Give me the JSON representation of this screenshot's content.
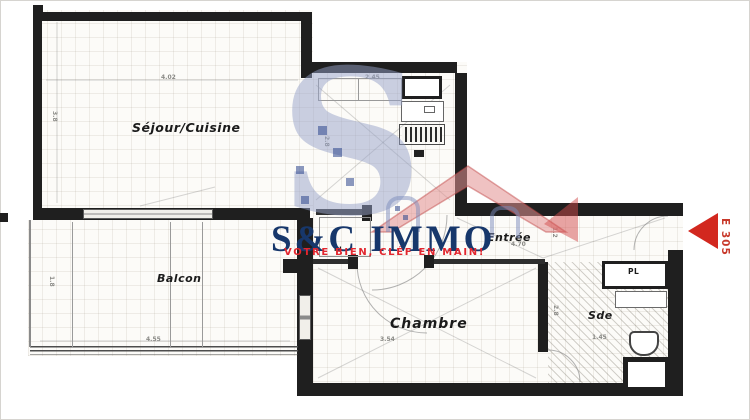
{
  "logo": {
    "title": "S&C IMMO",
    "tagline": "VOTRE BIEN, CLÉF EN MAIN!",
    "watermark_letter": "S"
  },
  "entry_marker": {
    "label": "E 305"
  },
  "rooms": {
    "sejour": {
      "label": "Séjour/Cuisine"
    },
    "balcon": {
      "label": "Balcon"
    },
    "entree": {
      "label": "Entrée"
    },
    "chambre": {
      "label": "Chambre"
    },
    "sde": {
      "label": "Sde"
    },
    "pl_entree": {
      "label": "PL"
    },
    "pl_sde": {
      "label": "PL"
    }
  },
  "dims": {
    "sejour_top": "4.02",
    "cuisine_top": "2.45",
    "entree_w": "4.70",
    "chambre_w": "3.54",
    "balcon_w": "4.55",
    "sde_w": "1.45",
    "sejour_left": "3.8",
    "balcon_left": "1.8",
    "cuisine_right": "2.8",
    "chambre_right": "2.8",
    "entree_right": "1.2"
  },
  "colors": {
    "wall": "#1f1f1f",
    "logo_navy": "#17376b",
    "logo_red": "#e2262e",
    "arrow_red": "#d2281f",
    "watermark_blue": "#96a2c8",
    "watermark_roof": "#dd8f8f"
  }
}
